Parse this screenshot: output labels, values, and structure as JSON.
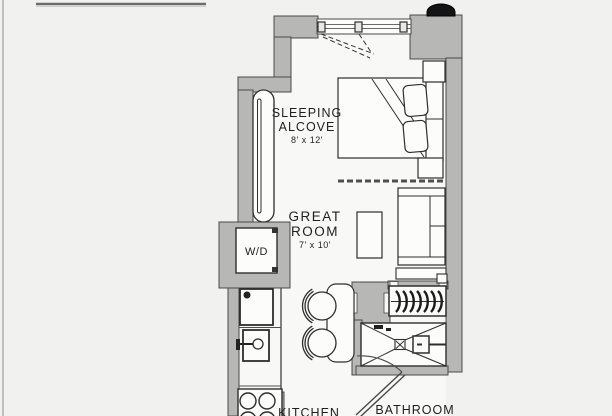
{
  "document": {
    "type": "floor-plan",
    "unit": "studio apartment plan"
  },
  "colors": {
    "background": "#f1f1ef",
    "interior": "#f8f8f6",
    "wall_fill": "#b7b7b5",
    "wall_stroke": "#4a4a4a",
    "fixture_stroke": "#2e2e2e",
    "fixture_fill": "#fcfcfb",
    "text": "#1f1f1f",
    "pipe": "#141414"
  },
  "rooms": {
    "sleeping_alcove": {
      "line1": "SLEEPING",
      "line2": "ALCOVE",
      "dims": "8' x 12'"
    },
    "great_room": {
      "line1": "GREAT",
      "line2": "ROOM",
      "dims": "7' x 10'"
    },
    "kitchen": {
      "label": "KITCHEN"
    },
    "bathroom": {
      "label": "BATHROOM"
    },
    "washer_dryer": {
      "label": "W/D"
    }
  },
  "fixtures": [
    "window",
    "casement-swing",
    "column-pipe",
    "radiator",
    "bed",
    "pillows",
    "nightstands",
    "curtain-track",
    "sofa",
    "console",
    "coffee-table",
    "dining-table",
    "chairs",
    "washer-dryer",
    "refrigerator",
    "sink",
    "faucet",
    "stove-4-burner",
    "closet-hanger-rod",
    "shower",
    "shower-drain",
    "shower-valve",
    "bathroom-door-swing"
  ]
}
